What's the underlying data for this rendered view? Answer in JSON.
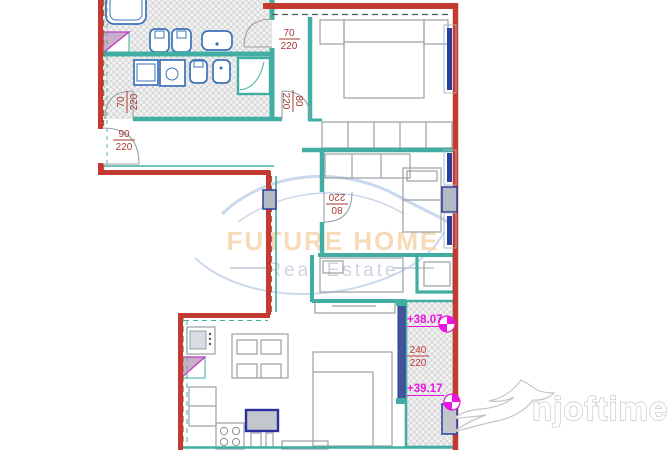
{
  "title": "apartment-floor-plan",
  "colors": {
    "outer_wall": "#c23a30",
    "inner_wall": "#42ada3",
    "window_blue": "#2b3f9e",
    "fixture_blue": "#3c72b8",
    "annotation_red": "#a33b31",
    "balcony_label_red": "#c03a3a",
    "level_magenta": "#e816e0",
    "watermark_brand_orange": "#f6dbb8",
    "watermark_tagline_gray": "#ced5df",
    "watermark_swoosh_blue": "#cbd9ec",
    "logo_outline_gray": "#c9c9c9"
  },
  "doors": [
    {
      "width": "70",
      "height": "220"
    },
    {
      "width": "70",
      "height": "220"
    },
    {
      "width": "80",
      "height": "220"
    },
    {
      "width": "90",
      "height": "220"
    },
    {
      "width": "80",
      "height": "220"
    },
    {
      "width": "240",
      "height": "220"
    }
  ],
  "levels": {
    "upper": "+38.07",
    "lower": "+39.17"
  },
  "watermark": {
    "brand": "FUTURE HOME",
    "tagline": "Real Estate"
  },
  "logo": {
    "site": "njoftime.al"
  }
}
